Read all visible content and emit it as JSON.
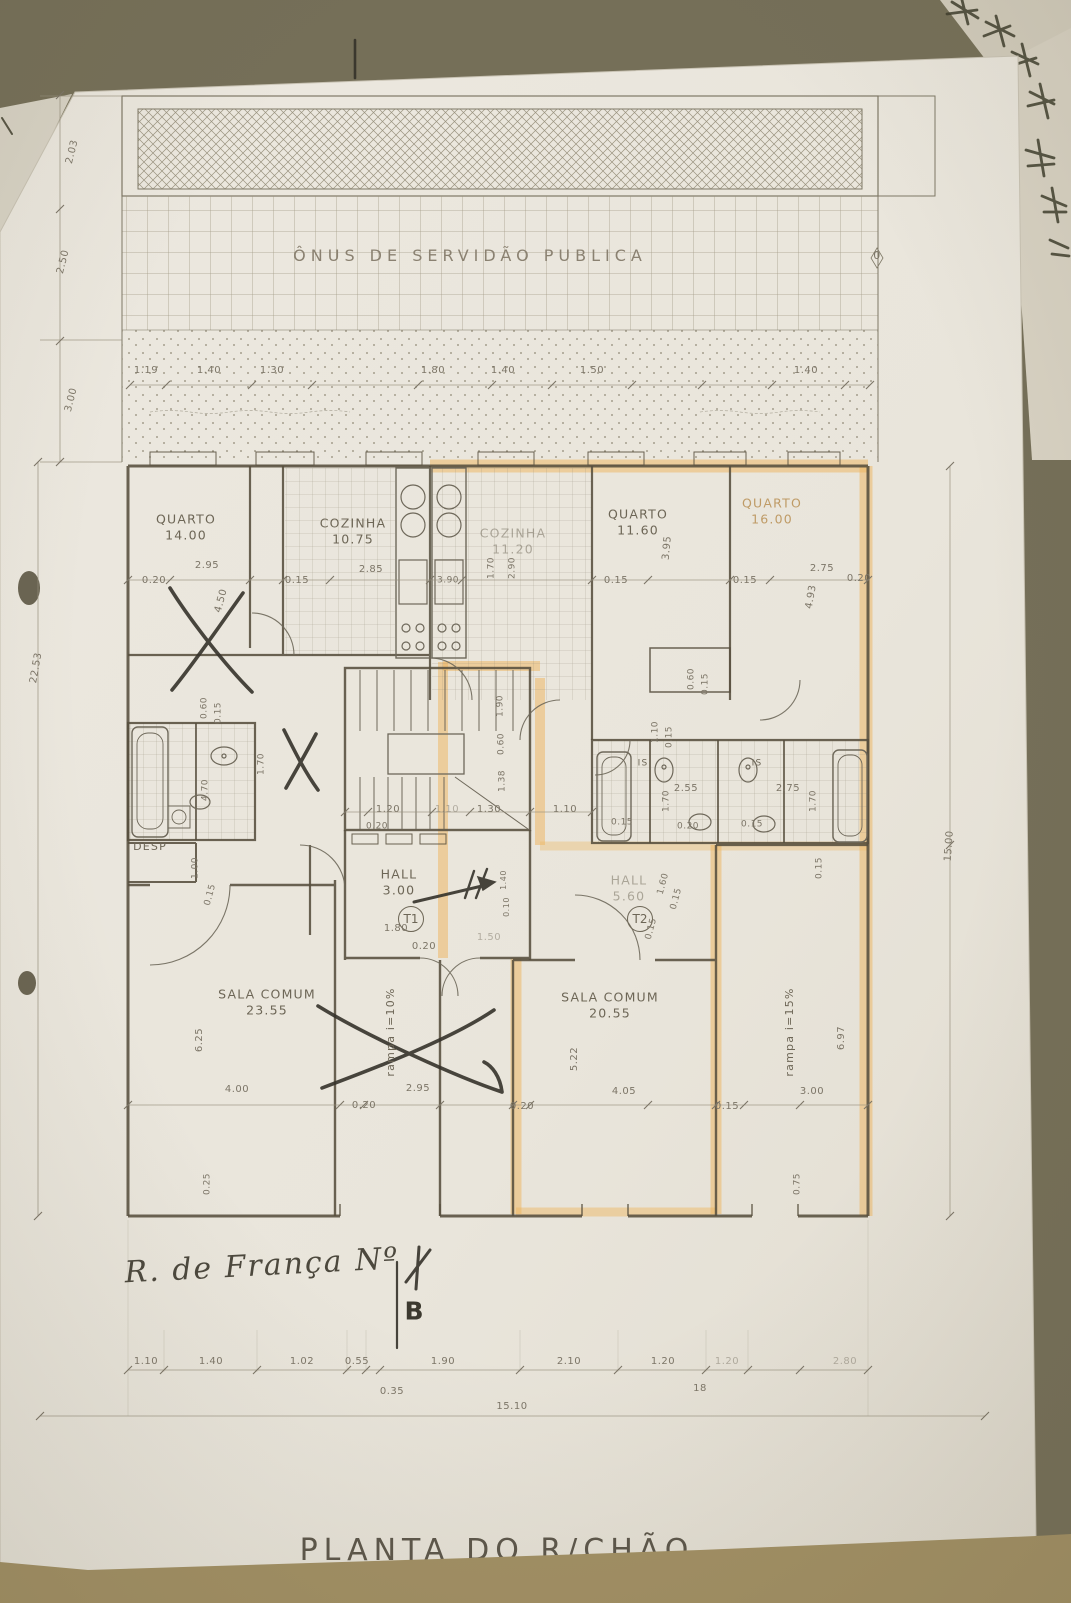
{
  "document": {
    "title": "PLANTA DO R/CHÃO",
    "servitude_label": "ÔNUS DE SERVIDÃO PUBLICA",
    "street_annotation": "R. de França Nº",
    "section_marker": "B"
  },
  "units": [
    {
      "id": "T1",
      "hall": "HALL 3.00"
    },
    {
      "id": "T2",
      "hall": "HALL 5.60"
    }
  ],
  "rooms": [
    {
      "name": "QUARTO",
      "area": "14.00"
    },
    {
      "name": "COZINHA",
      "area": "10.75"
    },
    {
      "name": "COZINHA",
      "area": "11.20"
    },
    {
      "name": "QUARTO",
      "area": "11.60"
    },
    {
      "name": "QUARTO",
      "area": "16.00"
    },
    {
      "name": "DESP"
    },
    {
      "name": "HALL",
      "area": "3.00"
    },
    {
      "name": "HALL",
      "area": "5.60"
    },
    {
      "name": "SALA COMUM",
      "area": "23.55"
    },
    {
      "name": "SALA COMUM",
      "area": "20.55"
    },
    {
      "name": "IS"
    },
    {
      "name": "IS"
    }
  ],
  "ramps": [
    "rampa  i=10%",
    "rampa  i=15%"
  ],
  "overall_dimensions": {
    "bottom_total": "15.10",
    "left_total": "22.53",
    "right_total": "15.00"
  },
  "colors": {
    "highlight": "#EDB45C",
    "paper": "#EBE7DE",
    "table": "#756F58",
    "pencil": "#6E685A",
    "ink": "#3A372E"
  },
  "labels": [
    {
      "t": "ÔNUS DE SERVIDÃO PUBLICA",
      "x": 470,
      "y": 256,
      "c": "spaced",
      "n": "servitude-label"
    },
    {
      "t": "R. de França Nº",
      "x": 262,
      "y": 1266,
      "r": -3,
      "c": "hand",
      "n": "handwritten-street"
    },
    {
      "t": "B",
      "x": 414,
      "y": 1311,
      "fs": 25,
      "c": "ink",
      "n": "section-marker"
    },
    {
      "t": "0",
      "x": 877,
      "y": 256,
      "fs": 11,
      "n": "dim-zero"
    },
    {
      "t": "QUARTO\n14.00",
      "x": 186,
      "y": 527,
      "c": "room",
      "n": "room-label-quarto-14"
    },
    {
      "t": "COZINHA\n10.75",
      "x": 353,
      "y": 531,
      "c": "room",
      "n": "room-label-cozinha-1075"
    },
    {
      "t": "COZINHA\n11.20",
      "x": 513,
      "y": 541,
      "c": "room faded",
      "n": "room-label-cozinha-1120"
    },
    {
      "t": "QUARTO\n11.60",
      "x": 638,
      "y": 522,
      "c": "room",
      "n": "room-label-quarto-1160"
    },
    {
      "t": "QUARTO\n16.00",
      "x": 772,
      "y": 511,
      "c": "room faded-orange",
      "n": "room-label-quarto-16"
    },
    {
      "t": "DESP",
      "x": 150,
      "y": 847,
      "fs": 11,
      "c": "room",
      "n": "room-label-desp"
    },
    {
      "t": "HALL\n3.00",
      "x": 399,
      "y": 882,
      "c": "room",
      "n": "room-label-hall-t1"
    },
    {
      "t": "T1",
      "x": 411,
      "y": 919,
      "c": "circle",
      "n": "unit-badge-t1"
    },
    {
      "t": "HALL\n5.60",
      "x": 629,
      "y": 888,
      "c": "room faded",
      "n": "room-label-hall-t2"
    },
    {
      "t": "T2",
      "x": 640,
      "y": 919,
      "c": "circle",
      "n": "unit-badge-t2"
    },
    {
      "t": "SALA COMUM\n23.55",
      "x": 267,
      "y": 1002,
      "c": "room",
      "n": "room-label-sala-2355"
    },
    {
      "t": "SALA COMUM\n20.55",
      "x": 610,
      "y": 1005,
      "c": "room",
      "n": "room-label-sala-2055"
    },
    {
      "t": "rampa  i=10%",
      "x": 391,
      "y": 1032,
      "r": -90,
      "fs": 11,
      "c": "room",
      "n": "ramp-label-10"
    },
    {
      "t": "rampa  i=15%",
      "x": 790,
      "y": 1032,
      "r": -90,
      "fs": 11,
      "c": "room",
      "n": "ramp-label-15"
    },
    {
      "t": "IS",
      "x": 643,
      "y": 764,
      "fs": 9,
      "c": "room",
      "n": "room-label-is-1"
    },
    {
      "t": "IS",
      "x": 757,
      "y": 764,
      "fs": 9,
      "c": "room",
      "n": "room-label-is-2"
    },
    {
      "t": "1.19",
      "x": 146,
      "y": 371
    },
    {
      "t": "1.40",
      "x": 209,
      "y": 371
    },
    {
      "t": "1.30",
      "x": 272,
      "y": 371
    },
    {
      "t": "1.80",
      "x": 433,
      "y": 371
    },
    {
      "t": "1.40",
      "x": 503,
      "y": 371
    },
    {
      "t": "1.50",
      "x": 592,
      "y": 371
    },
    {
      "t": "1.40",
      "x": 806,
      "y": 371
    },
    {
      "t": "0.20",
      "x": 154,
      "y": 581
    },
    {
      "t": "2.95",
      "x": 207,
      "y": 566
    },
    {
      "t": "4.50",
      "x": 222,
      "y": 601,
      "r": -75
    },
    {
      "t": "0.15",
      "x": 297,
      "y": 581
    },
    {
      "t": "2.85",
      "x": 371,
      "y": 570
    },
    {
      "t": "3.90",
      "x": 448,
      "y": 581,
      "fs": 9
    },
    {
      "t": "1.70",
      "x": 492,
      "y": 568,
      "r": -90,
      "fs": 9
    },
    {
      "t": "2.90",
      "x": 513,
      "y": 568,
      "r": -90,
      "fs": 9
    },
    {
      "t": "0.15",
      "x": 616,
      "y": 581
    },
    {
      "t": "3.95",
      "x": 668,
      "y": 548,
      "r": -85
    },
    {
      "t": "0.15",
      "x": 745,
      "y": 581
    },
    {
      "t": "2.75",
      "x": 822,
      "y": 569
    },
    {
      "t": "0.20",
      "x": 859,
      "y": 579
    },
    {
      "t": "4.93",
      "x": 812,
      "y": 597,
      "r": -80
    },
    {
      "t": "0.60",
      "x": 205,
      "y": 708,
      "r": -90,
      "fs": 9
    },
    {
      "t": "0.15",
      "x": 219,
      "y": 713,
      "r": -90,
      "fs": 9
    },
    {
      "t": "1.70",
      "x": 262,
      "y": 764,
      "r": -90,
      "fs": 9
    },
    {
      "t": "4.70",
      "x": 206,
      "y": 790,
      "r": -90,
      "fs": 9
    },
    {
      "t": "1.00",
      "x": 196,
      "y": 868,
      "r": -90,
      "fs": 9
    },
    {
      "t": "0.15",
      "x": 211,
      "y": 895,
      "r": -75,
      "fs": 9
    },
    {
      "t": "1.90",
      "x": 501,
      "y": 706,
      "r": -90,
      "fs": 9
    },
    {
      "t": "0.60",
      "x": 502,
      "y": 744,
      "r": -90,
      "fs": 9
    },
    {
      "t": "1.38",
      "x": 503,
      "y": 781,
      "r": -90,
      "fs": 9
    },
    {
      "t": "1.20",
      "x": 388,
      "y": 810
    },
    {
      "t": "1.10",
      "x": 447,
      "y": 810,
      "c": "dim faded"
    },
    {
      "t": "1.30",
      "x": 489,
      "y": 810
    },
    {
      "t": "1.10",
      "x": 565,
      "y": 810
    },
    {
      "t": "0.20",
      "x": 377,
      "y": 827,
      "fs": 9
    },
    {
      "t": "0.20",
      "x": 688,
      "y": 827,
      "fs": 9
    },
    {
      "t": "1.10",
      "x": 656,
      "y": 732,
      "r": -90,
      "fs": 9
    },
    {
      "t": "0.15",
      "x": 670,
      "y": 737,
      "r": -90,
      "fs": 9
    },
    {
      "t": "0.60",
      "x": 692,
      "y": 679,
      "r": -90,
      "fs": 9
    },
    {
      "t": "0.15",
      "x": 706,
      "y": 684,
      "r": -90,
      "fs": 9
    },
    {
      "t": "2.55",
      "x": 686,
      "y": 789
    },
    {
      "t": "1.70",
      "x": 667,
      "y": 801,
      "r": -90,
      "fs": 9
    },
    {
      "t": "2.75",
      "x": 788,
      "y": 789
    },
    {
      "t": "1.70",
      "x": 814,
      "y": 801,
      "r": -90,
      "fs": 9
    },
    {
      "t": "0.15",
      "x": 622,
      "y": 823,
      "fs": 9
    },
    {
      "t": "0.15",
      "x": 752,
      "y": 825,
      "fs": 9
    },
    {
      "t": "1.60",
      "x": 664,
      "y": 884,
      "r": -75,
      "fs": 9
    },
    {
      "t": "0.15",
      "x": 677,
      "y": 899,
      "r": -75,
      "fs": 9
    },
    {
      "t": "0.15",
      "x": 652,
      "y": 929,
      "r": -75,
      "fs": 9
    },
    {
      "t": "0.15",
      "x": 820,
      "y": 868,
      "r": -90,
      "fs": 9
    },
    {
      "t": "1.80",
      "x": 396,
      "y": 929
    },
    {
      "t": "0.20",
      "x": 424,
      "y": 947
    },
    {
      "t": "1.50",
      "x": 489,
      "y": 938,
      "c": "dim faded"
    },
    {
      "t": "1.40",
      "x": 504,
      "y": 880,
      "r": -90,
      "fs": 8
    },
    {
      "t": "0.10",
      "x": 507,
      "y": 907,
      "r": -90,
      "fs": 8
    },
    {
      "t": "6.25",
      "x": 200,
      "y": 1040,
      "r": -90
    },
    {
      "t": "4.00",
      "x": 237,
      "y": 1090
    },
    {
      "t": "0.25",
      "x": 208,
      "y": 1184,
      "r": -90,
      "fs": 9
    },
    {
      "t": "0.20",
      "x": 364,
      "y": 1106
    },
    {
      "t": "2.95",
      "x": 418,
      "y": 1089
    },
    {
      "t": "4.05",
      "x": 624,
      "y": 1092
    },
    {
      "t": "5.22",
      "x": 575,
      "y": 1059,
      "r": -90
    },
    {
      "t": "0.20",
      "x": 522,
      "y": 1107
    },
    {
      "t": "0.15",
      "x": 727,
      "y": 1107
    },
    {
      "t": "3.00",
      "x": 812,
      "y": 1092
    },
    {
      "t": "6.97",
      "x": 842,
      "y": 1038,
      "r": -90
    },
    {
      "t": "0.75",
      "x": 798,
      "y": 1184,
      "r": -90,
      "fs": 9
    },
    {
      "t": "1.10",
      "x": 146,
      "y": 1362
    },
    {
      "t": "1.40",
      "x": 211,
      "y": 1362
    },
    {
      "t": "1.02",
      "x": 302,
      "y": 1362
    },
    {
      "t": "0.55",
      "x": 357,
      "y": 1362
    },
    {
      "t": "1.90",
      "x": 443,
      "y": 1362
    },
    {
      "t": "2.10",
      "x": 569,
      "y": 1362
    },
    {
      "t": "1.20",
      "x": 663,
      "y": 1362
    },
    {
      "t": "1.20",
      "x": 727,
      "y": 1362,
      "c": "dim faded"
    },
    {
      "t": "2.80",
      "x": 845,
      "y": 1362,
      "c": "dim faded"
    },
    {
      "t": "18",
      "x": 700,
      "y": 1389
    },
    {
      "t": "0.35",
      "x": 392,
      "y": 1392
    },
    {
      "t": "15.10",
      "x": 512,
      "y": 1407
    },
    {
      "t": "2.03",
      "x": 73,
      "y": 152,
      "r": -76
    },
    {
      "t": "2.50",
      "x": 64,
      "y": 262,
      "r": -76
    },
    {
      "t": "3.00",
      "x": 72,
      "y": 400,
      "r": -76
    },
    {
      "t": "22.53",
      "x": 37,
      "y": 668,
      "r": -80
    },
    {
      "t": "15.00",
      "x": 950,
      "y": 846,
      "r": -86
    }
  ]
}
